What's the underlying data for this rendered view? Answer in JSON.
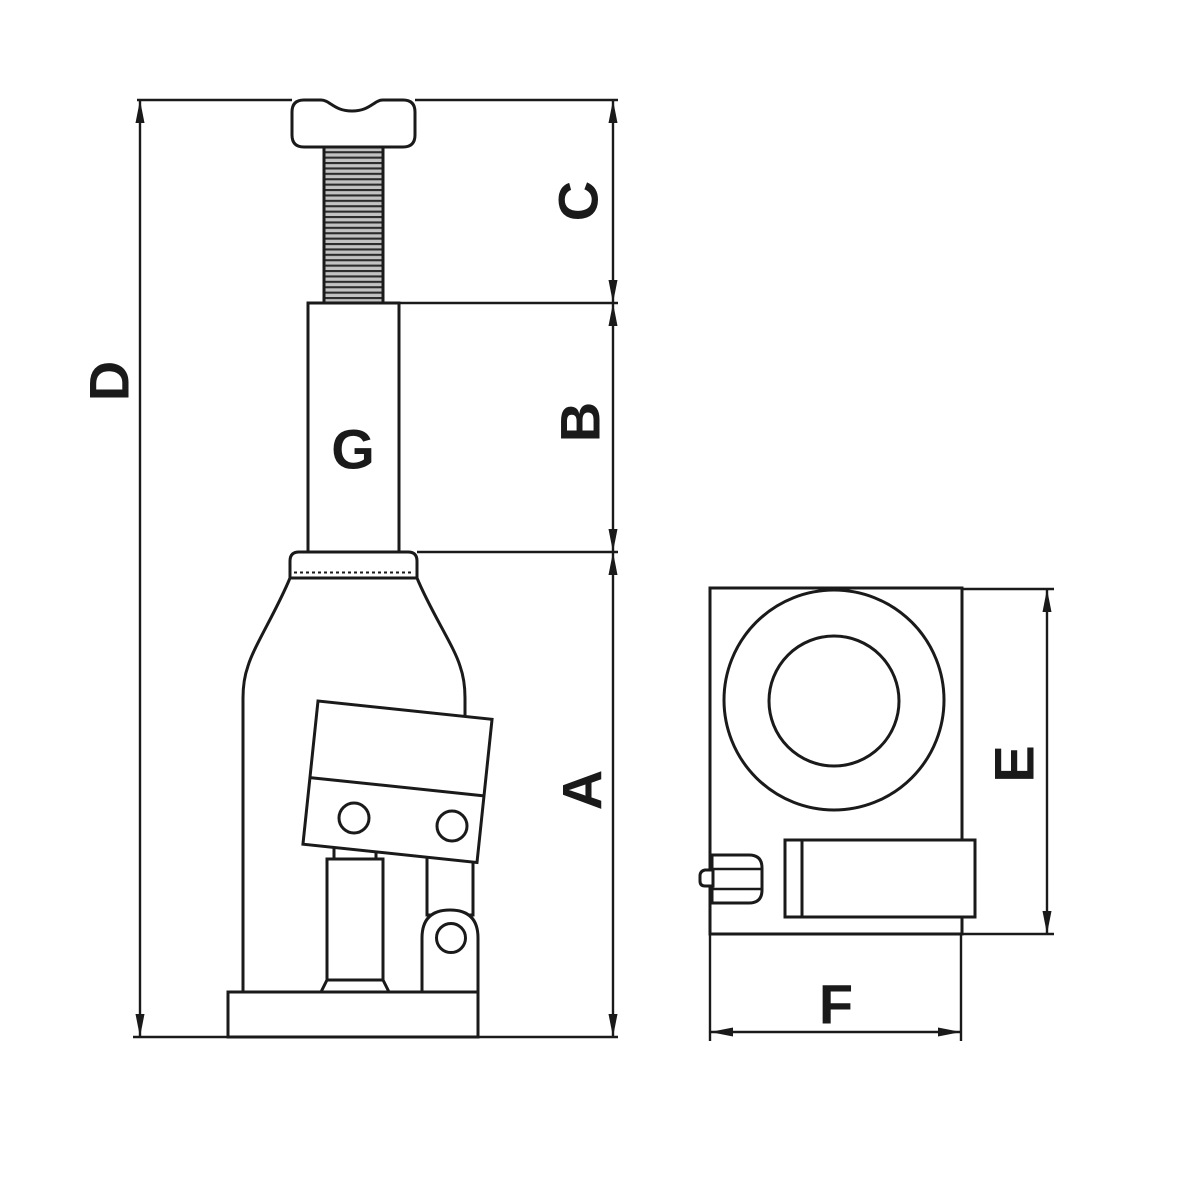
{
  "drawing": {
    "kind": "bottle-jack dimension diagram",
    "colors": {
      "background": "#ffffff",
      "line": "#1a1a1a",
      "thread_fill": "#c2c2c2"
    },
    "side_view": {
      "labels": {
        "overall_height": "D",
        "screw_section": "C",
        "ram_section": "B",
        "body_section": "A",
        "ram_width": "G"
      }
    },
    "top_view": {
      "labels": {
        "depth": "E",
        "width": "F"
      }
    }
  }
}
